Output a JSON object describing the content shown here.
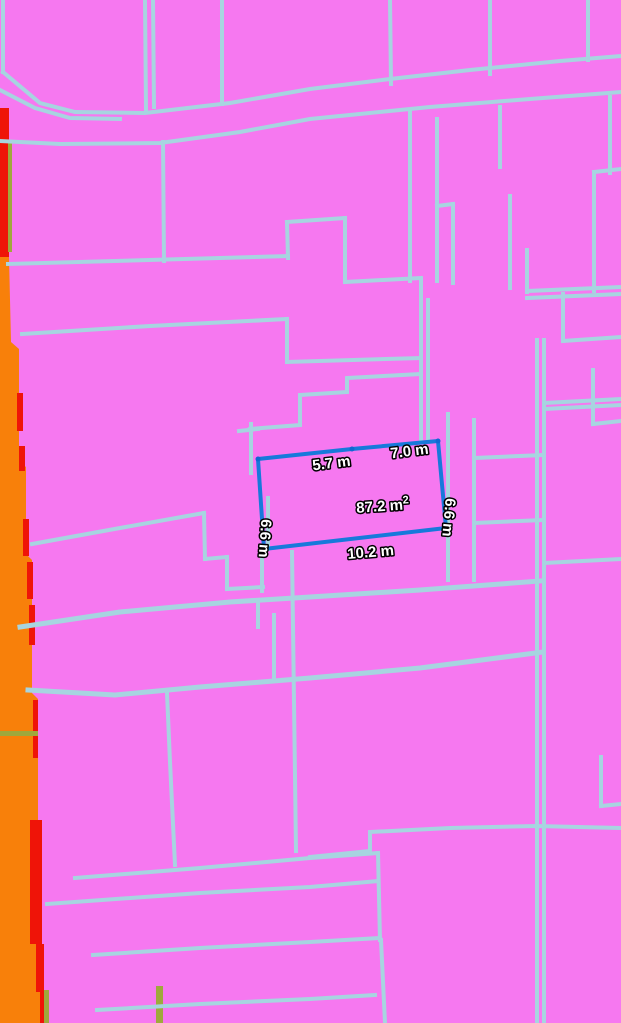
{
  "colors": {
    "background": "#F678F0",
    "parcel_line": "#A7D4E0",
    "zone_orange": "#F8800A",
    "zone_red": "#EF1408",
    "zone_olive": "#9FA83C",
    "measure_stroke": "#1779DB",
    "measure_vertex": "#1067D2",
    "label_fill": "#FFFFFF",
    "label_outline": "#000000"
  },
  "map": {
    "width": 621,
    "height": 1023,
    "parcel_lines": [
      {
        "pts": [
          [
            3,
            0
          ],
          [
            3,
            72
          ]
        ]
      },
      {
        "pts": [
          [
            3,
            72
          ],
          [
            40,
            103
          ],
          [
            75,
            112
          ],
          [
            145,
            113
          ],
          [
            230,
            103
          ],
          [
            310,
            89
          ],
          [
            390,
            79
          ],
          [
            470,
            70
          ],
          [
            560,
            61
          ],
          [
            621,
            56
          ]
        ]
      },
      {
        "pts": [
          [
            0,
            90
          ],
          [
            35,
            108
          ],
          [
            70,
            118
          ],
          [
            120,
            119
          ]
        ]
      },
      {
        "pts": [
          [
            0,
            141
          ],
          [
            60,
            144
          ],
          [
            160,
            143
          ],
          [
            240,
            132
          ],
          [
            310,
            119
          ],
          [
            430,
            107
          ],
          [
            530,
            99
          ],
          [
            621,
            92
          ]
        ]
      },
      {
        "pts": [
          [
            145,
            0
          ],
          [
            146,
            110
          ]
        ]
      },
      {
        "pts": [
          [
            153,
            0
          ],
          [
            154,
            107
          ]
        ]
      },
      {
        "pts": [
          [
            222,
            0
          ],
          [
            222,
            104
          ]
        ]
      },
      {
        "pts": [
          [
            390,
            0
          ],
          [
            391,
            84
          ]
        ]
      },
      {
        "pts": [
          [
            490,
            0
          ],
          [
            490,
            74
          ]
        ]
      },
      {
        "pts": [
          [
            588,
            0
          ],
          [
            588,
            60
          ]
        ]
      },
      {
        "pts": [
          [
            610,
            97
          ],
          [
            610,
            173
          ]
        ]
      },
      {
        "pts": [
          [
            594,
            172
          ],
          [
            621,
            169
          ]
        ]
      },
      {
        "pts": [
          [
            594,
            172
          ],
          [
            594,
            291
          ]
        ]
      },
      {
        "pts": [
          [
            527,
            291
          ],
          [
            621,
            287
          ]
        ]
      },
      {
        "pts": [
          [
            527,
            298
          ],
          [
            621,
            294
          ]
        ]
      },
      {
        "pts": [
          [
            527,
            250
          ],
          [
            527,
            292
          ]
        ]
      },
      {
        "pts": [
          [
            563,
            294
          ],
          [
            563,
            341
          ]
        ]
      },
      {
        "pts": [
          [
            563,
            341
          ],
          [
            621,
            337
          ]
        ]
      },
      {
        "pts": [
          [
            410,
            112
          ],
          [
            410,
            281
          ]
        ]
      },
      {
        "pts": [
          [
            437,
            119
          ],
          [
            437,
            281
          ]
        ]
      },
      {
        "pts": [
          [
            437,
            206
          ],
          [
            453,
            204
          ]
        ]
      },
      {
        "pts": [
          [
            453,
            204
          ],
          [
            453,
            283
          ]
        ]
      },
      {
        "pts": [
          [
            500,
            107
          ],
          [
            500,
            167
          ]
        ]
      },
      {
        "pts": [
          [
            510,
            196
          ],
          [
            510,
            288
          ]
        ]
      },
      {
        "pts": [
          [
            287,
            222
          ],
          [
            345,
            218
          ]
        ]
      },
      {
        "pts": [
          [
            345,
            218
          ],
          [
            345,
            282
          ]
        ]
      },
      {
        "pts": [
          [
            345,
            282
          ],
          [
            421,
            278
          ]
        ]
      },
      {
        "pts": [
          [
            287,
            222
          ],
          [
            288,
            258
          ]
        ]
      },
      {
        "pts": [
          [
            8,
            264
          ],
          [
            288,
            256
          ]
        ]
      },
      {
        "pts": [
          [
            163,
            142
          ],
          [
            164,
            261
          ]
        ]
      },
      {
        "pts": [
          [
            22,
            334
          ],
          [
            150,
            326
          ],
          [
            287,
            319
          ]
        ]
      },
      {
        "pts": [
          [
            287,
            319
          ],
          [
            287,
            362
          ]
        ]
      },
      {
        "pts": [
          [
            287,
            362
          ],
          [
            420,
            358
          ]
        ]
      },
      {
        "pts": [
          [
            250,
            429
          ],
          [
            300,
            425
          ],
          [
            300,
            395
          ],
          [
            347,
            392
          ],
          [
            347,
            378
          ],
          [
            421,
            374
          ]
        ]
      },
      {
        "pts": [
          [
            421,
            279
          ],
          [
            421,
            441
          ]
        ]
      },
      {
        "pts": [
          [
            428,
            300
          ],
          [
            428,
            438
          ]
        ]
      },
      {
        "pts": [
          [
            251,
            424
          ],
          [
            251,
            473
          ]
        ]
      },
      {
        "pts": [
          [
            239,
            431
          ],
          [
            258,
            429
          ]
        ]
      },
      {
        "pts": [
          [
            448,
            414
          ],
          [
            448,
            580
          ]
        ]
      },
      {
        "pts": [
          [
            474,
            420
          ],
          [
            474,
            580
          ]
        ]
      },
      {
        "pts": [
          [
            474,
            458
          ],
          [
            544,
            455
          ]
        ]
      },
      {
        "pts": [
          [
            474,
            523
          ],
          [
            544,
            520
          ]
        ]
      },
      {
        "pts": [
          [
            262,
            549
          ],
          [
            262,
            591
          ]
        ]
      },
      {
        "pts": [
          [
            268,
            498
          ],
          [
            268,
            549
          ]
        ]
      },
      {
        "pts": [
          [
            32,
            544
          ],
          [
            120,
            528
          ],
          [
            204,
            513
          ]
        ]
      },
      {
        "pts": [
          [
            204,
            513
          ],
          [
            205,
            559
          ]
        ]
      },
      {
        "pts": [
          [
            205,
            559
          ],
          [
            227,
            557
          ]
        ]
      },
      {
        "pts": [
          [
            227,
            557
          ],
          [
            227,
            589
          ]
        ]
      },
      {
        "pts": [
          [
            227,
            589
          ],
          [
            263,
            587
          ]
        ]
      },
      {
        "pts": [
          [
            20,
            627
          ],
          [
            120,
            612
          ],
          [
            230,
            602
          ],
          [
            310,
            597
          ],
          [
            420,
            590
          ],
          [
            540,
            581
          ]
        ],
        "w": 5
      },
      {
        "pts": [
          [
            28,
            690
          ],
          [
            115,
            695
          ],
          [
            200,
            687
          ],
          [
            310,
            678
          ],
          [
            420,
            668
          ],
          [
            543,
            652
          ]
        ],
        "w": 5
      },
      {
        "pts": [
          [
            258,
            600
          ],
          [
            258,
            627
          ]
        ]
      },
      {
        "pts": [
          [
            274,
            615
          ],
          [
            274,
            679
          ]
        ]
      },
      {
        "pts": [
          [
            292,
            552
          ],
          [
            296,
            851
          ]
        ]
      },
      {
        "pts": [
          [
            537,
            340
          ],
          [
            537,
            1023
          ]
        ]
      },
      {
        "pts": [
          [
            544,
            340
          ],
          [
            544,
            1023
          ]
        ]
      },
      {
        "pts": [
          [
            544,
            403
          ],
          [
            621,
            399
          ]
        ]
      },
      {
        "pts": [
          [
            544,
            409
          ],
          [
            621,
            405
          ]
        ]
      },
      {
        "pts": [
          [
            593,
            370
          ],
          [
            593,
            424
          ]
        ]
      },
      {
        "pts": [
          [
            593,
            424
          ],
          [
            621,
            421
          ]
        ]
      },
      {
        "pts": [
          [
            544,
            563
          ],
          [
            621,
            559
          ]
        ]
      },
      {
        "pts": [
          [
            167,
            693
          ],
          [
            170,
            762
          ],
          [
            175,
            865
          ]
        ]
      },
      {
        "pts": [
          [
            310,
            857
          ],
          [
            370,
            851
          ],
          [
            370,
            832
          ],
          [
            450,
            828
          ],
          [
            536,
            826
          ],
          [
            621,
            828
          ]
        ]
      },
      {
        "pts": [
          [
            601,
            757
          ],
          [
            601,
            806
          ]
        ]
      },
      {
        "pts": [
          [
            601,
            806
          ],
          [
            621,
            804
          ]
        ]
      },
      {
        "pts": [
          [
            75,
            878
          ],
          [
            200,
            868
          ],
          [
            310,
            858
          ],
          [
            378,
            853
          ]
        ]
      },
      {
        "pts": [
          [
            47,
            904
          ],
          [
            200,
            893
          ],
          [
            310,
            887
          ],
          [
            378,
            881
          ]
        ]
      },
      {
        "pts": [
          [
            93,
            955
          ],
          [
            200,
            948
          ],
          [
            310,
            942
          ],
          [
            380,
            938
          ]
        ]
      },
      {
        "pts": [
          [
            97,
            1010
          ],
          [
            200,
            1004
          ],
          [
            310,
            999
          ],
          [
            375,
            995
          ]
        ]
      },
      {
        "pts": [
          [
            378,
            853
          ],
          [
            380,
            940
          ]
        ]
      },
      {
        "pts": [
          [
            381,
            940
          ],
          [
            385,
            1023
          ]
        ]
      }
    ]
  },
  "zones": {
    "orange_polygon": [
      [
        0,
        257
      ],
      [
        9,
        257
      ],
      [
        11,
        342
      ],
      [
        19,
        349
      ],
      [
        19,
        461
      ],
      [
        26,
        467
      ],
      [
        26,
        554
      ],
      [
        32,
        560
      ],
      [
        32,
        693
      ],
      [
        38,
        699
      ],
      [
        38,
        940
      ],
      [
        44,
        948
      ],
      [
        44,
        1023
      ],
      [
        0,
        1023
      ]
    ],
    "red_rects": [
      [
        0,
        108,
        9,
        149
      ],
      [
        17,
        393,
        6,
        38
      ],
      [
        19,
        446,
        6,
        25
      ],
      [
        23,
        519,
        6,
        37
      ],
      [
        27,
        562,
        6,
        37
      ],
      [
        29,
        605,
        6,
        40
      ],
      [
        33,
        700,
        5,
        58
      ],
      [
        30,
        820,
        12,
        124
      ],
      [
        36,
        944,
        8,
        48
      ],
      [
        40,
        990,
        4,
        33
      ]
    ],
    "olive_rects": [
      [
        8,
        140,
        4,
        112
      ],
      [
        0,
        731,
        38,
        5
      ],
      [
        156,
        986,
        7,
        37
      ],
      [
        44,
        990,
        5,
        33
      ]
    ]
  },
  "measurement": {
    "polygon": [
      [
        258,
        459
      ],
      [
        352,
        449
      ],
      [
        438,
        441
      ],
      [
        446,
        528
      ],
      [
        264,
        549
      ]
    ],
    "stroke_width": 4,
    "labels": [
      {
        "text": "5.7 m",
        "x": 332,
        "y": 468,
        "rotate": -7
      },
      {
        "text": "7.0 m",
        "x": 410,
        "y": 456,
        "rotate": -7
      },
      {
        "text": "87.2 m",
        "sup": "2",
        "x": 383,
        "y": 511,
        "rotate": -4
      },
      {
        "text": "6.6 m",
        "x": 260,
        "y": 538,
        "rotate": 94
      },
      {
        "text": "6.6 m",
        "x": 444,
        "y": 517,
        "rotate": 95
      },
      {
        "text": "10.2 m",
        "x": 371,
        "y": 557,
        "rotate": -5
      }
    ]
  }
}
